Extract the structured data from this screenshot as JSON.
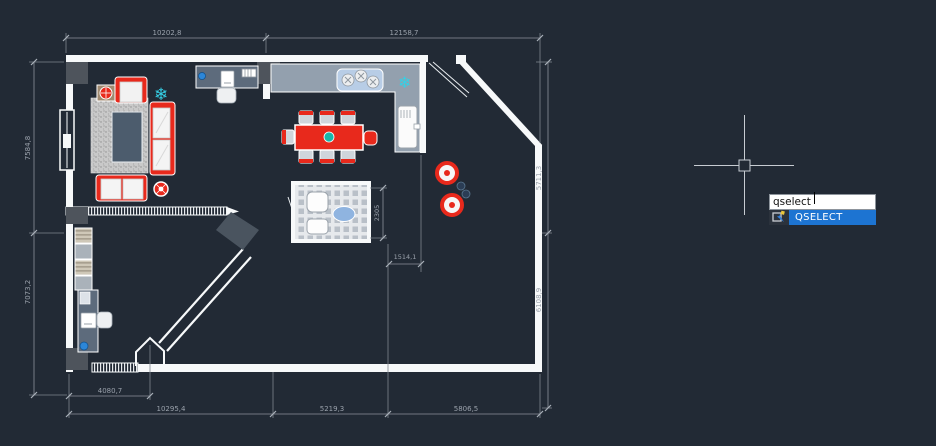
{
  "app": {
    "name": "cad-drawing-canvas"
  },
  "canvas": {
    "background": "#222a35",
    "wall_color": "#f7f9fa",
    "dimension_color": "#9aa1ab",
    "furniture_red": "#e8291c",
    "accent_teal": "#16b8ac",
    "accent_cyan": "#35d0e6",
    "accent_blue": "#2c86d8",
    "highlight_blue": "#1d74d2"
  },
  "dimensions": {
    "top_left": "10202,8",
    "top_right": "12158,7",
    "left_upper": "7584,8",
    "left_lower": "7073,2",
    "right_upper": "5711,3",
    "right_lower": "6108,9",
    "bottom_inner_left": "4080,7",
    "bottom_left": "10295,4",
    "bottom_middle": "5219,3",
    "bottom_right": "5806,5",
    "interior_small": "1514,1",
    "bathroom_height": "2305"
  },
  "command_input": {
    "value": "qselect"
  },
  "autocomplete": {
    "items": [
      {
        "label": "QSELECT",
        "icon": "qselect-icon",
        "selected": true
      }
    ]
  }
}
